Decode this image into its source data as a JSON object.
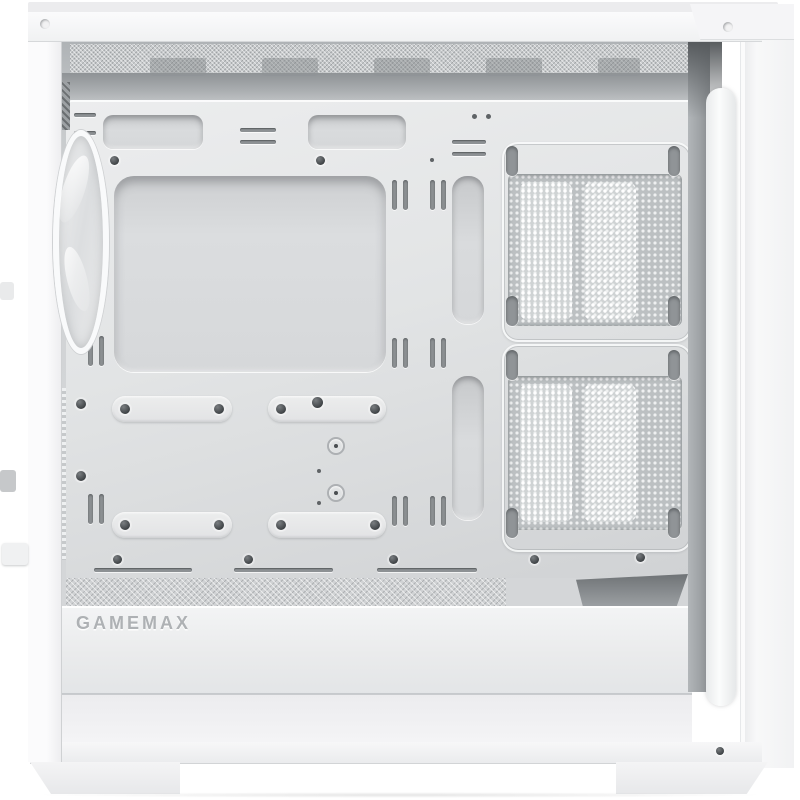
{
  "image": {
    "kind": "product-photo",
    "subject": "White PC tower case with side panel removed showing interior",
    "view": "side interior view, slight three-quarter angle"
  },
  "brand": {
    "logo_text": "GAMEMAX"
  },
  "palette": {
    "background": "#ffffff",
    "case_white": "#f6f6f7",
    "tray_light": "#e9eaec",
    "tray_shadow": "#cfd1d3",
    "mesh_gray": "#bcc0c2",
    "deep_shadow": "#8f9396",
    "screw_dark": "#3e4245",
    "logo_gray": "#aeb1b4"
  },
  "features": {
    "front_fan_count": 1,
    "fan_mount_positions": 2,
    "cable_grommets_top": 2,
    "cable_routing_cutouts": 2,
    "ssd_mount_slots": 4,
    "case_feet": 2
  }
}
